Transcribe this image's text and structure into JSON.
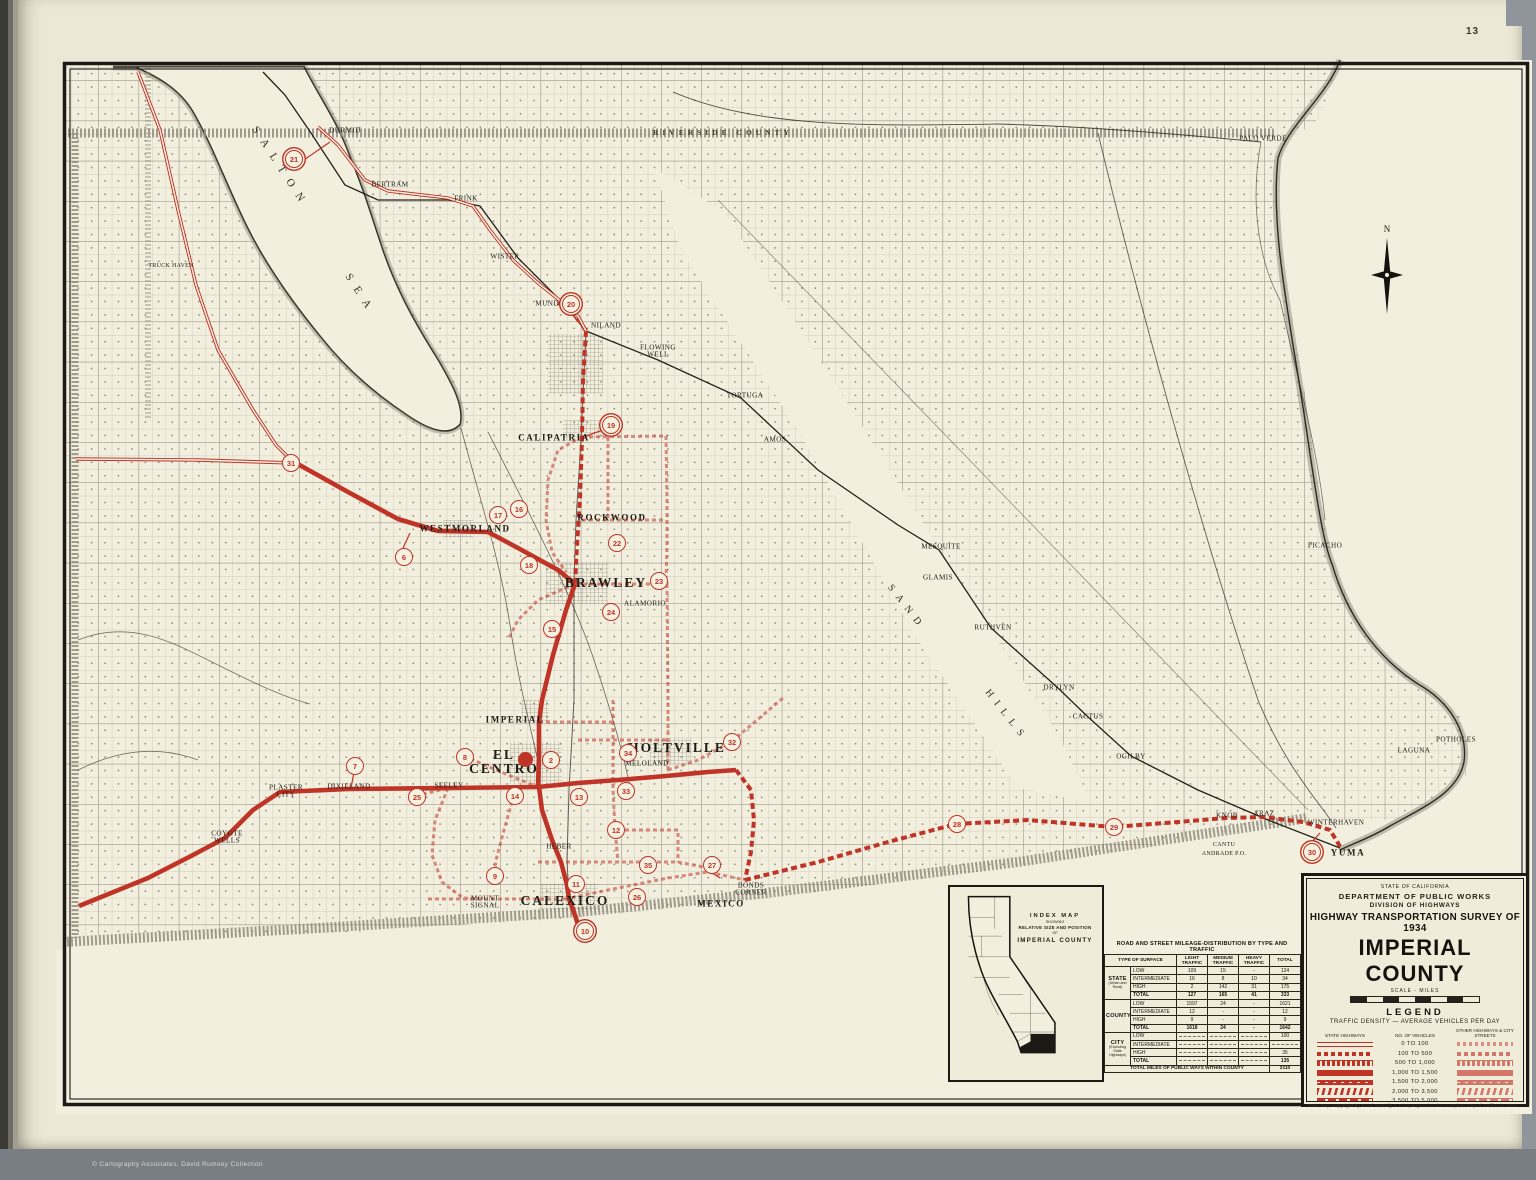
{
  "page": {
    "number": "13"
  },
  "footer": {
    "collection_credit": "© Cartography Associates, David Rumsey Collection"
  },
  "title_block": {
    "state": "STATE OF CALIFORNIA",
    "department": "DEPARTMENT OF PUBLIC WORKS",
    "division": "DIVISION OF HIGHWAYS",
    "survey": "HIGHWAY TRANSPORTATION SURVEY OF 1934",
    "county": "IMPERIAL COUNTY",
    "scale_label": "SCALE - MILES",
    "legend_title": "LEGEND",
    "legend_subtitle": "TRAFFIC DENSITY — AVERAGE VEHICLES PER DAY",
    "col_state": "STATE HIGHWAYS",
    "col_vehicles": "NO. OF VEHICLES",
    "col_other": "OTHER HIGHWAYS & CITY STREETS",
    "census_label": "CITY OF CENSUS",
    "density_label": "DENSITY STATIONS",
    "origin_label": "ORIGIN STATIONS",
    "base_note": "Base Map Copyright by Rand McNally & Company under the Complete Map of California 1934"
  },
  "legend": {
    "rows": [
      {
        "range": "0 TO 100"
      },
      {
        "range": "100 TO 500"
      },
      {
        "range": "500 TO 1,000"
      },
      {
        "range": "1,000 TO 1,500"
      },
      {
        "range": "1,500 TO 2,000"
      },
      {
        "range": "2,000 TO 3,500"
      },
      {
        "range": "3,500 TO 5,000"
      },
      {
        "range": "5,000 TO 7,500"
      }
    ]
  },
  "mileage_table": {
    "title": "ROAD AND STREET MILEAGE-DISTRIBUTION BY TYPE AND TRAFFIC",
    "col_headers": [
      "TYPE OF SURFACE",
      "LIGHT TRAFFIC",
      "MEDIUM TRAFFIC",
      "HEAVY TRAFFIC",
      "TOTAL"
    ],
    "groups": [
      {
        "name": "STATE",
        "note": "(Urban and Rural)",
        "rows": [
          [
            "LOW",
            "109",
            "15",
            "-",
            "124"
          ],
          [
            "INTERMEDIATE",
            "16",
            "8",
            "10",
            "34"
          ],
          [
            "HIGH",
            "2",
            "142",
            "31",
            "175"
          ]
        ],
        "total": [
          "TOTAL",
          "127",
          "165",
          "41",
          "333"
        ]
      },
      {
        "name": "COUNTY",
        "note": "",
        "rows": [
          [
            "LOW",
            "1597",
            "24",
            "-",
            "1621"
          ],
          [
            "INTERMEDIATE",
            "12",
            "-",
            "-",
            "12"
          ],
          [
            "HIGH",
            "9",
            "-",
            "-",
            "9"
          ]
        ],
        "total": [
          "TOTAL",
          "1618",
          "24",
          "-",
          "1642"
        ]
      },
      {
        "name": "CITY",
        "note": "(Excluding State Highways)",
        "rows": [
          [
            "LOW",
            "",
            "",
            "",
            "100"
          ],
          [
            "INTERMEDIATE",
            "",
            "",
            "",
            ""
          ],
          [
            "HIGH",
            "",
            "",
            "",
            "35"
          ]
        ],
        "total": [
          "TOTAL",
          "",
          "",
          "",
          "135"
        ]
      }
    ],
    "footer": [
      "TOTAL MILES OF PUBLIC WAYS WITHIN COUNTY",
      "2110"
    ]
  },
  "index_map": {
    "lines": [
      "INDEX MAP",
      "SHOWING",
      "RELATIVE SIZE AND POSITION",
      "OF",
      "IMPERIAL COUNTY"
    ]
  },
  "compass": {
    "north": "N"
  },
  "map": {
    "census_city": {
      "name": "EL CENTRO",
      "x": 507,
      "y": 759
    },
    "places": [
      {
        "t": "DURMID",
        "x": 327,
        "y": 131
      },
      {
        "t": "BERTRAM",
        "x": 372,
        "y": 185
      },
      {
        "t": "FRINK",
        "x": 448,
        "y": 199
      },
      {
        "t": "WISTER",
        "x": 487,
        "y": 257
      },
      {
        "t": "MUNDO",
        "x": 532,
        "y": 304
      },
      {
        "t": "NILAND",
        "x": 588,
        "y": 326
      },
      {
        "t": "FLOWING\nWELL",
        "x": 640,
        "y": 352
      },
      {
        "t": "TORTUGA",
        "x": 727,
        "y": 396
      },
      {
        "t": "AMOS",
        "x": 757,
        "y": 440
      },
      {
        "t": "CALIPATRIA",
        "x": 536,
        "y": 438,
        "c": "md"
      },
      {
        "t": "ROCKWOOD",
        "x": 594,
        "y": 518,
        "c": "md"
      },
      {
        "t": "WESTMORLAND",
        "x": 447,
        "y": 529,
        "c": "md"
      },
      {
        "t": "BRAWLEY",
        "x": 588,
        "y": 583,
        "c": "lg"
      },
      {
        "t": "ALAMORIO",
        "x": 627,
        "y": 604
      },
      {
        "t": "MESQUITE",
        "x": 923,
        "y": 547
      },
      {
        "t": "GLAMIS",
        "x": 920,
        "y": 578
      },
      {
        "t": "RUTHVEN",
        "x": 975,
        "y": 628
      },
      {
        "t": "DRYLYN",
        "x": 1041,
        "y": 688
      },
      {
        "t": "CACTUS",
        "x": 1070,
        "y": 717
      },
      {
        "t": "OGILBY",
        "x": 1113,
        "y": 757
      },
      {
        "t": "PICACHO",
        "x": 1307,
        "y": 546
      },
      {
        "t": "POTHOLES",
        "x": 1438,
        "y": 740
      },
      {
        "t": "LAGUNA",
        "x": 1396,
        "y": 751
      },
      {
        "t": "PALO VERDE",
        "x": 1245,
        "y": 139
      },
      {
        "t": "TRUCK HAVEN",
        "x": 153,
        "y": 266,
        "c": "xs"
      },
      {
        "t": "IMPERIAL",
        "x": 497,
        "y": 720,
        "c": "md"
      },
      {
        "t": "EL\nCENTRO",
        "x": 486,
        "y": 762,
        "c": "lg"
      },
      {
        "t": "SEELEY",
        "x": 431,
        "y": 786
      },
      {
        "t": "MELOLAND",
        "x": 629,
        "y": 764
      },
      {
        "t": "HOLTVILLE",
        "x": 659,
        "y": 748,
        "c": "lg"
      },
      {
        "t": "HEBER",
        "x": 541,
        "y": 847
      },
      {
        "t": "MOUNT\nSIGNAL",
        "x": 467,
        "y": 903
      },
      {
        "t": "CALEXICO",
        "x": 547,
        "y": 901,
        "c": "lg"
      },
      {
        "t": "MEXICO",
        "x": 703,
        "y": 904,
        "c": "md"
      },
      {
        "t": "BONDS\nCORNER",
        "x": 733,
        "y": 890
      },
      {
        "t": "PLASTER\nCITY",
        "x": 268,
        "y": 792
      },
      {
        "t": "DIXIELAND",
        "x": 331,
        "y": 787
      },
      {
        "t": "COYOTE\nWELLS",
        "x": 209,
        "y": 838
      },
      {
        "t": "KNOB",
        "x": 1209,
        "y": 816
      },
      {
        "t": "ARAZ",
        "x": 1246,
        "y": 814
      },
      {
        "t": "CANTU",
        "x": 1206,
        "y": 845,
        "c": "xs"
      },
      {
        "t": "ANDRADE P.O.",
        "x": 1206,
        "y": 854,
        "c": "xs"
      },
      {
        "t": "WINTERHAVEN",
        "x": 1318,
        "y": 823
      },
      {
        "t": "YUMA",
        "x": 1330,
        "y": 853,
        "c": "md"
      },
      {
        "t": "RIVERSIDE COUNTY",
        "x": 705,
        "y": 133,
        "c": "band"
      },
      {
        "t": "SALTON",
        "x": 262,
        "y": 168,
        "c": "sea",
        "r": 57
      },
      {
        "t": "SEA",
        "x": 342,
        "y": 295,
        "c": "sea",
        "r": 57
      },
      {
        "t": "SAND",
        "x": 888,
        "y": 608,
        "c": "hills",
        "r": 52
      },
      {
        "t": "HILLS",
        "x": 988,
        "y": 716,
        "c": "hills",
        "r": 52
      }
    ],
    "stations": [
      {
        "n": "2",
        "x": 532,
        "y": 759
      },
      {
        "n": "6",
        "x": 385,
        "y": 556
      },
      {
        "n": "7",
        "x": 336,
        "y": 765
      },
      {
        "n": "8",
        "x": 446,
        "y": 756
      },
      {
        "n": "9",
        "x": 476,
        "y": 875
      },
      {
        "n": "10",
        "x": 566,
        "y": 930,
        "o": true
      },
      {
        "n": "11",
        "x": 557,
        "y": 883
      },
      {
        "n": "12",
        "x": 597,
        "y": 829
      },
      {
        "n": "13",
        "x": 560,
        "y": 796
      },
      {
        "n": "14",
        "x": 496,
        "y": 795
      },
      {
        "n": "15",
        "x": 533,
        "y": 628
      },
      {
        "n": "16",
        "x": 500,
        "y": 508
      },
      {
        "n": "17",
        "x": 479,
        "y": 514
      },
      {
        "n": "18",
        "x": 510,
        "y": 564
      },
      {
        "n": "19",
        "x": 592,
        "y": 424,
        "o": true
      },
      {
        "n": "20",
        "x": 552,
        "y": 303,
        "o": true
      },
      {
        "n": "21",
        "x": 275,
        "y": 158,
        "o": true
      },
      {
        "n": "22",
        "x": 598,
        "y": 542
      },
      {
        "n": "23",
        "x": 640,
        "y": 580
      },
      {
        "n": "24",
        "x": 592,
        "y": 611
      },
      {
        "n": "25",
        "x": 398,
        "y": 796
      },
      {
        "n": "26",
        "x": 618,
        "y": 896
      },
      {
        "n": "27",
        "x": 693,
        "y": 864
      },
      {
        "n": "28",
        "x": 938,
        "y": 823
      },
      {
        "n": "29",
        "x": 1095,
        "y": 826
      },
      {
        "n": "30",
        "x": 1293,
        "y": 851,
        "o": true
      },
      {
        "n": "31",
        "x": 272,
        "y": 462
      },
      {
        "n": "32",
        "x": 713,
        "y": 741
      },
      {
        "n": "33",
        "x": 607,
        "y": 790
      },
      {
        "n": "34",
        "x": 609,
        "y": 752
      },
      {
        "n": "35",
        "x": 629,
        "y": 864
      }
    ]
  }
}
